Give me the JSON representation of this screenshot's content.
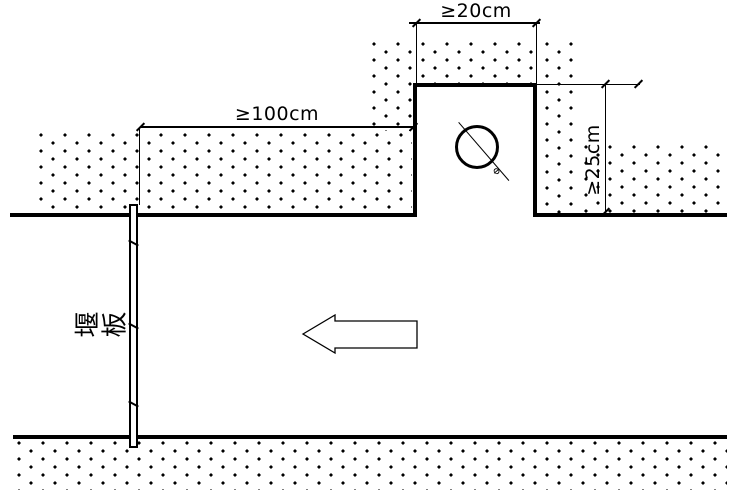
{
  "diagram": {
    "dimensions": {
      "top": "≥20cm",
      "left": "≥100cm",
      "right": "≥25cm"
    },
    "labels": {
      "weir_board": "堰板",
      "pipe": "Φ"
    },
    "colors": {
      "line": "#000000",
      "background": "#ffffff"
    }
  }
}
